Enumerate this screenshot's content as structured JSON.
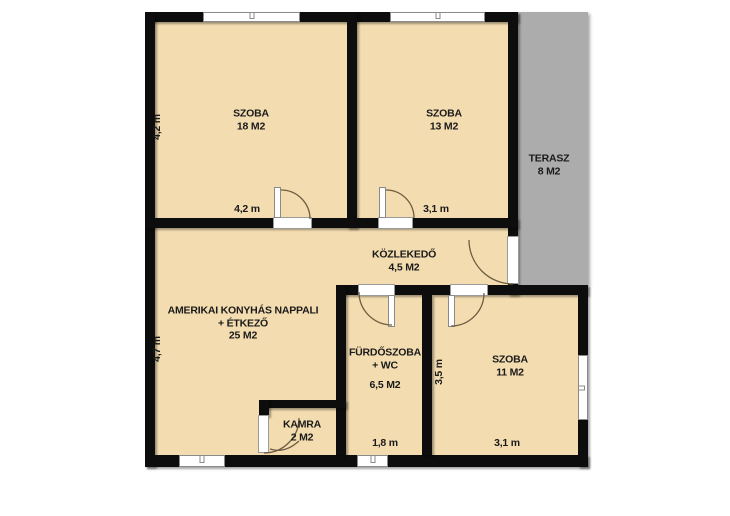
{
  "colors": {
    "wall": "#0D0D0D",
    "room_fill": "#F3DCB0",
    "terrace_fill": "#ACACAC",
    "opening_fill": "#FFFFFF"
  },
  "rooms": {
    "szoba18": {
      "name": "SZOBA",
      "area": "18 M2"
    },
    "szoba13": {
      "name": "SZOBA",
      "area": "13 M2"
    },
    "terasz": {
      "name": "TERASZ",
      "area": "8 M2"
    },
    "kozlekedo": {
      "name": "KÖZLEKEDŐ",
      "area": "4,5 M2"
    },
    "nappali": {
      "name": "AMERIKAI KONYHÁS NAPPALI",
      "name2": "+ ÉTKEZŐ",
      "area": "25 M2"
    },
    "furdoszoba": {
      "name": "FÜRDŐSZOBA",
      "name2": "+ WC",
      "area": "6,5 M2"
    },
    "kamra": {
      "name": "KAMRA",
      "area": "2 M2"
    },
    "szoba11": {
      "name": "SZOBA",
      "area": "11 M2"
    }
  },
  "dimensions": {
    "szoba18_height": "4,2 m",
    "szoba18_width": "4,2 m",
    "szoba13_width": "3,1 m",
    "nappali_height": "4,7 m",
    "szoba11_height": "3,5 m",
    "furdoszoba_width": "1,8 m",
    "szoba11_width": "3,1 m"
  }
}
